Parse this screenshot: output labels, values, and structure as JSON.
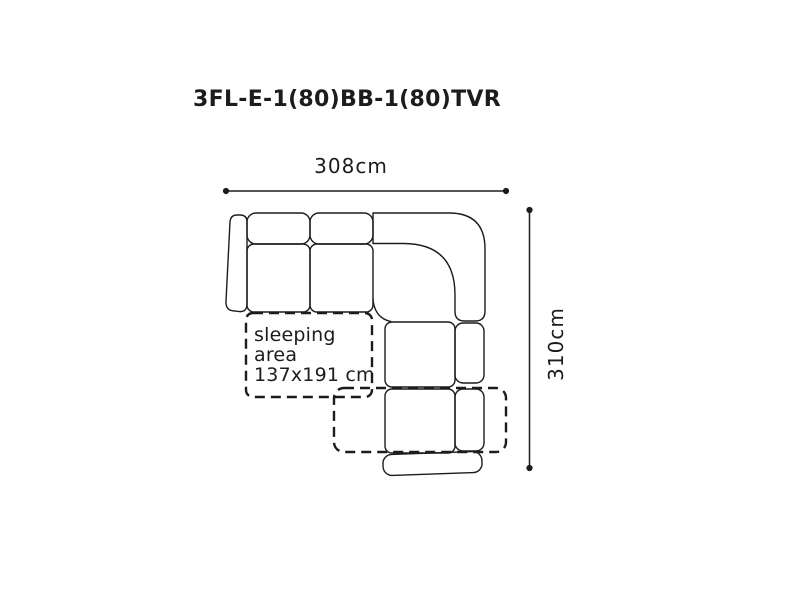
{
  "title": "3FL-E-1(80)BB-1(80)TVR",
  "dimensions": {
    "width": "308cm",
    "height": "310cm"
  },
  "sleeping_area": {
    "line1": "sleeping",
    "line2": "area",
    "line3": "137x191 cm"
  },
  "colors": {
    "ink": "#1c1c1c",
    "background": "#ffffff"
  }
}
